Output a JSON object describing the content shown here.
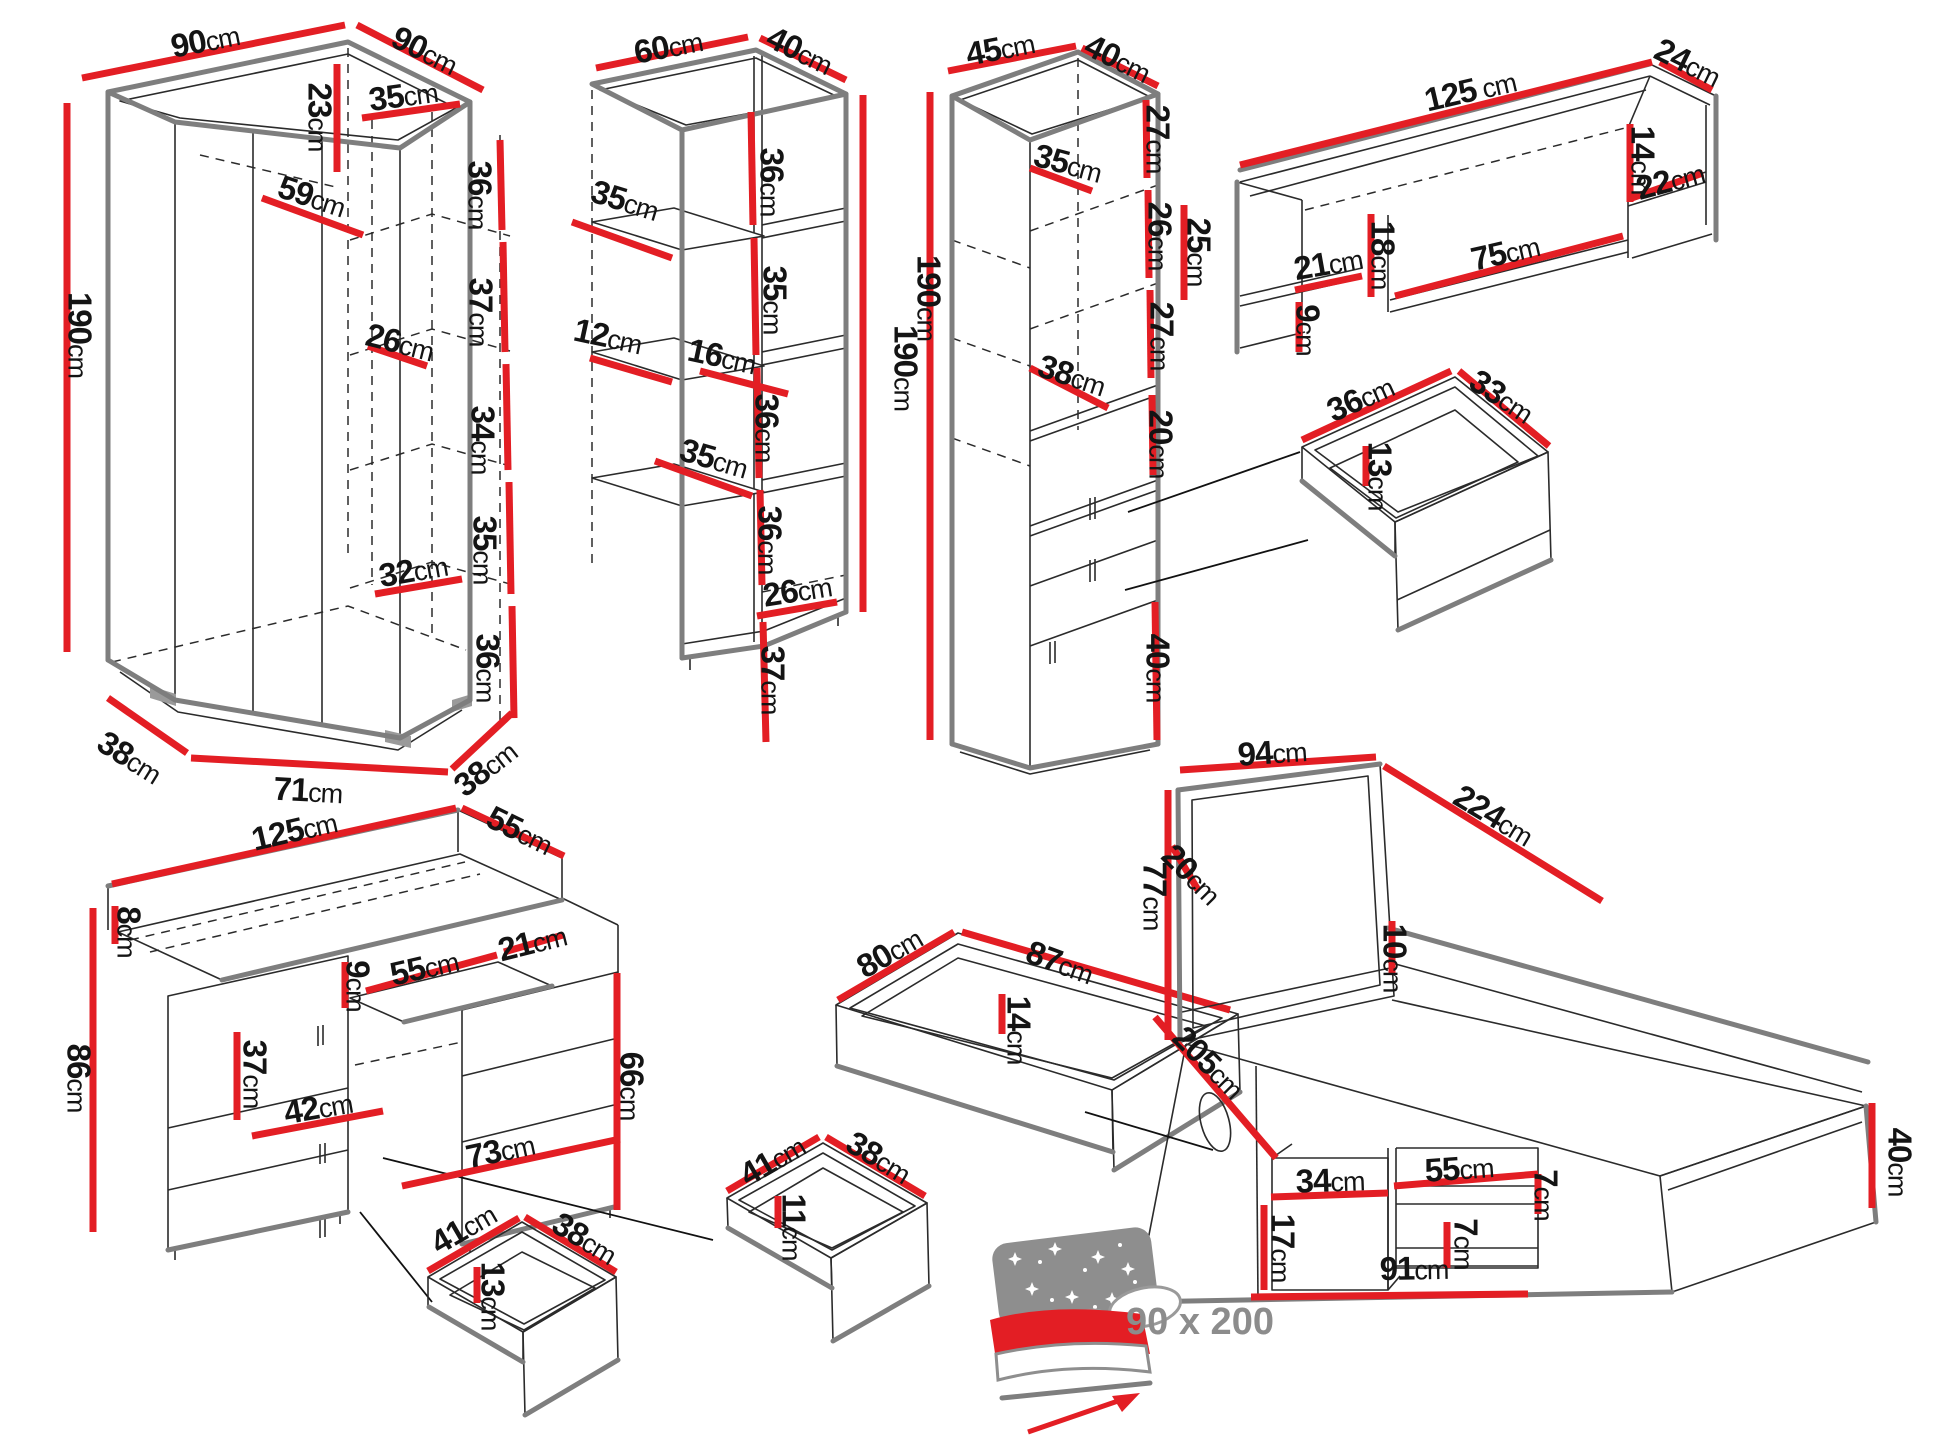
{
  "title": "Furniture set dimensions diagram",
  "unit": "cm",
  "colors": {
    "dimension_line": "#e31e24",
    "outline_thick": "#7e7e7e",
    "outline_thin": "#2b2b2b",
    "label_text": "#141414",
    "muted_text": "#8c8c8c",
    "background": "#ffffff"
  },
  "mattress_note": "90 x 200",
  "pieces": [
    {
      "id": "corner-wardrobe",
      "name": "corner wardrobe 90x90x190",
      "labels": [
        {
          "v": "90",
          "u": "cm",
          "x": 205,
          "y": 40,
          "r": -11
        },
        {
          "v": "90",
          "u": "cm",
          "x": 425,
          "y": 50,
          "r": 26
        },
        {
          "v": "35",
          "u": "cm",
          "x": 403,
          "y": 95,
          "r": -8
        },
        {
          "v": "23",
          "u": "cm",
          "x": 320,
          "y": 117,
          "r": 90
        },
        {
          "v": "59",
          "u": "cm",
          "x": 312,
          "y": 196,
          "r": 18
        },
        {
          "v": "190",
          "u": "cm",
          "x": 80,
          "y": 335,
          "r": 90
        },
        {
          "v": "36",
          "u": "cm",
          "x": 480,
          "y": 195,
          "r": 90
        },
        {
          "v": "37",
          "u": "cm",
          "x": 481,
          "y": 312,
          "r": 90
        },
        {
          "v": "26",
          "u": "cm",
          "x": 400,
          "y": 342,
          "r": 14
        },
        {
          "v": "34",
          "u": "cm",
          "x": 483,
          "y": 440,
          "r": 90
        },
        {
          "v": "35",
          "u": "cm",
          "x": 485,
          "y": 550,
          "r": 90
        },
        {
          "v": "32",
          "u": "cm",
          "x": 413,
          "y": 570,
          "r": -10
        },
        {
          "v": "36",
          "u": "cm",
          "x": 488,
          "y": 668,
          "r": 90
        },
        {
          "v": "38",
          "u": "cm",
          "x": 130,
          "y": 757,
          "r": 32
        },
        {
          "v": "71",
          "u": "cm",
          "x": 308,
          "y": 790,
          "r": 3
        },
        {
          "v": "38",
          "u": "cm",
          "x": 485,
          "y": 768,
          "r": -38
        }
      ]
    },
    {
      "id": "open-shelf-unit",
      "name": "open shelf unit 60x40x190",
      "labels": [
        {
          "v": "60",
          "u": "cm",
          "x": 668,
          "y": 46,
          "r": -11
        },
        {
          "v": "40",
          "u": "cm",
          "x": 800,
          "y": 50,
          "r": 26
        },
        {
          "v": "35",
          "u": "cm",
          "x": 625,
          "y": 200,
          "r": 17
        },
        {
          "v": "36",
          "u": "cm",
          "x": 772,
          "y": 182,
          "r": 90
        },
        {
          "v": "12",
          "u": "cm",
          "x": 608,
          "y": 336,
          "r": 12
        },
        {
          "v": "16",
          "u": "cm",
          "x": 722,
          "y": 356,
          "r": 12
        },
        {
          "v": "35",
          "u": "cm",
          "x": 775,
          "y": 300,
          "r": 90
        },
        {
          "v": "35",
          "u": "cm",
          "x": 714,
          "y": 458,
          "r": 16
        },
        {
          "v": "36",
          "u": "cm",
          "x": 767,
          "y": 428,
          "r": 90
        },
        {
          "v": "36",
          "u": "cm",
          "x": 770,
          "y": 540,
          "r": 90
        },
        {
          "v": "26",
          "u": "cm",
          "x": 797,
          "y": 590,
          "r": -9
        },
        {
          "v": "37",
          "u": "cm",
          "x": 773,
          "y": 680,
          "r": 90
        },
        {
          "v": "190",
          "u": "cm",
          "x": 906,
          "y": 368,
          "r": 90
        }
      ]
    },
    {
      "id": "tall-cabinet",
      "name": "tall cabinet 45x40x190",
      "labels": [
        {
          "v": "45",
          "u": "cm",
          "x": 1000,
          "y": 48,
          "r": -11
        },
        {
          "v": "40",
          "u": "cm",
          "x": 1118,
          "y": 58,
          "r": 26
        },
        {
          "v": "35",
          "u": "cm",
          "x": 1068,
          "y": 163,
          "r": 15
        },
        {
          "v": "27",
          "u": "cm",
          "x": 1158,
          "y": 139,
          "r": 90
        },
        {
          "v": "26",
          "u": "cm",
          "x": 1160,
          "y": 236,
          "r": 90
        },
        {
          "v": "27",
          "u": "cm",
          "x": 1162,
          "y": 336,
          "r": 90
        },
        {
          "v": "38",
          "u": "cm",
          "x": 1072,
          "y": 375,
          "r": 18
        },
        {
          "v": "20",
          "u": "cm",
          "x": 1161,
          "y": 444,
          "r": 90
        },
        {
          "v": "40",
          "u": "cm",
          "x": 1158,
          "y": 668,
          "r": 90
        },
        {
          "v": "190",
          "u": "cm",
          "x": 929,
          "y": 298,
          "r": 90
        }
      ]
    },
    {
      "id": "wall-shelf",
      "name": "wall shelf 125x24",
      "labels": [
        {
          "v": "125",
          "u": " cm",
          "x": 1470,
          "y": 90,
          "r": -13
        },
        {
          "v": "24",
          "u": "cm",
          "x": 1688,
          "y": 62,
          "r": 26
        },
        {
          "v": "25",
          "u": "cm",
          "x": 1199,
          "y": 252,
          "r": 90
        },
        {
          "v": "21",
          "u": "cm",
          "x": 1328,
          "y": 263,
          "r": -10
        },
        {
          "v": "9",
          "u": "cm",
          "x": 1308,
          "y": 330,
          "r": 90
        },
        {
          "v": "18",
          "u": "cm",
          "x": 1383,
          "y": 255,
          "r": 90
        },
        {
          "v": "75",
          "u": "cm",
          "x": 1505,
          "y": 252,
          "r": -13
        },
        {
          "v": "14",
          "u": "cm",
          "x": 1643,
          "y": 160,
          "r": 90
        },
        {
          "v": "22",
          "u": "cm",
          "x": 1670,
          "y": 180,
          "r": -15
        }
      ]
    },
    {
      "id": "drawer-36x33",
      "name": "drawer insert 36x33x13",
      "labels": [
        {
          "v": "36",
          "u": "cm",
          "x": 1360,
          "y": 398,
          "r": -24
        },
        {
          "v": "33",
          "u": "cm",
          "x": 1502,
          "y": 396,
          "r": 33
        },
        {
          "v": "13",
          "u": "cm",
          "x": 1380,
          "y": 476,
          "r": 90
        }
      ]
    },
    {
      "id": "desk",
      "name": "desk 125x55x86",
      "labels": [
        {
          "v": "125",
          "u": "cm",
          "x": 294,
          "y": 830,
          "r": -13
        },
        {
          "v": "55",
          "u": "cm",
          "x": 520,
          "y": 830,
          "r": 26
        },
        {
          "v": "8",
          "u": "cm",
          "x": 129,
          "y": 932,
          "r": 90
        },
        {
          "v": "86",
          "u": "cm",
          "x": 79,
          "y": 1078,
          "r": 90
        },
        {
          "v": "9",
          "u": "cm",
          "x": 358,
          "y": 986,
          "r": 90
        },
        {
          "v": "55",
          "u": "cm",
          "x": 424,
          "y": 967,
          "r": -13
        },
        {
          "v": "21",
          "u": "cm",
          "x": 532,
          "y": 942,
          "r": -14
        },
        {
          "v": "37",
          "u": "cm",
          "x": 255,
          "y": 1074,
          "r": 90
        },
        {
          "v": "42",
          "u": "cm",
          "x": 318,
          "y": 1107,
          "r": -10
        },
        {
          "v": "66",
          "u": "cm",
          "x": 632,
          "y": 1086,
          "r": 90
        },
        {
          "v": "73",
          "u": "cm",
          "x": 500,
          "y": 1150,
          "r": -12
        }
      ]
    },
    {
      "id": "drawer-41x38x13",
      "name": "desk drawer 41x38x13",
      "labels": [
        {
          "v": "41",
          "u": "cm",
          "x": 463,
          "y": 1228,
          "r": -30
        },
        {
          "v": "38",
          "u": "cm",
          "x": 585,
          "y": 1238,
          "r": 31
        },
        {
          "v": "13",
          "u": "cm",
          "x": 493,
          "y": 1296,
          "r": 90
        }
      ]
    },
    {
      "id": "drawer-80x87",
      "name": "underbed drawer 80x87x14",
      "labels": [
        {
          "v": "80",
          "u": "cm",
          "x": 889,
          "y": 952,
          "r": -30
        },
        {
          "v": "87",
          "u": "cm",
          "x": 1060,
          "y": 962,
          "r": 20
        },
        {
          "v": "14",
          "u": "cm",
          "x": 1019,
          "y": 1030,
          "r": 90
        }
      ]
    },
    {
      "id": "drawer-41x38x11",
      "name": "drawer insert 41x38x11",
      "labels": [
        {
          "v": "41",
          "u": "cm",
          "x": 772,
          "y": 1160,
          "r": -30
        },
        {
          "v": "38",
          "u": "cm",
          "x": 879,
          "y": 1157,
          "r": 31
        },
        {
          "v": "11",
          "u": "cm",
          "x": 794,
          "y": 1227,
          "r": 90
        }
      ]
    },
    {
      "id": "bed",
      "name": "bed 90x200 with storage",
      "labels": [
        {
          "v": "94",
          "u": "cm",
          "x": 1272,
          "y": 752,
          "r": -4
        },
        {
          "v": "224",
          "u": "cm",
          "x": 1494,
          "y": 815,
          "r": 31
        },
        {
          "v": "77",
          "u": "cm",
          "x": 1155,
          "y": 896,
          "r": 90
        },
        {
          "v": "20",
          "u": "cm",
          "x": 1192,
          "y": 874,
          "r": 45
        },
        {
          "v": "10",
          "u": "cm",
          "x": 1395,
          "y": 958,
          "r": 90
        },
        {
          "v": "205",
          "u": "cm",
          "x": 1209,
          "y": 1062,
          "r": 45
        },
        {
          "v": "34",
          "u": "cm",
          "x": 1330,
          "y": 1180,
          "r": -2
        },
        {
          "v": "55",
          "u": "cm",
          "x": 1459,
          "y": 1168,
          "r": -4
        },
        {
          "v": "7",
          "u": "cm",
          "x": 1546,
          "y": 1195,
          "r": 90
        },
        {
          "v": "7",
          "u": "cm",
          "x": 1466,
          "y": 1244,
          "r": 90
        },
        {
          "v": "17",
          "u": "cm",
          "x": 1283,
          "y": 1248,
          "r": 90
        },
        {
          "v": "91",
          "u": "cm",
          "x": 1414,
          "y": 1268,
          "r": -1
        },
        {
          "v": "40",
          "u": "cm",
          "x": 1900,
          "y": 1162,
          "r": 90
        }
      ]
    },
    {
      "id": "mattress-size-note",
      "name": "mattress size note",
      "labels": [
        {
          "v": "90 x 200",
          "u": "",
          "x": 1200,
          "y": 1322,
          "r": 0,
          "s": 38,
          "c": "note"
        }
      ]
    }
  ]
}
